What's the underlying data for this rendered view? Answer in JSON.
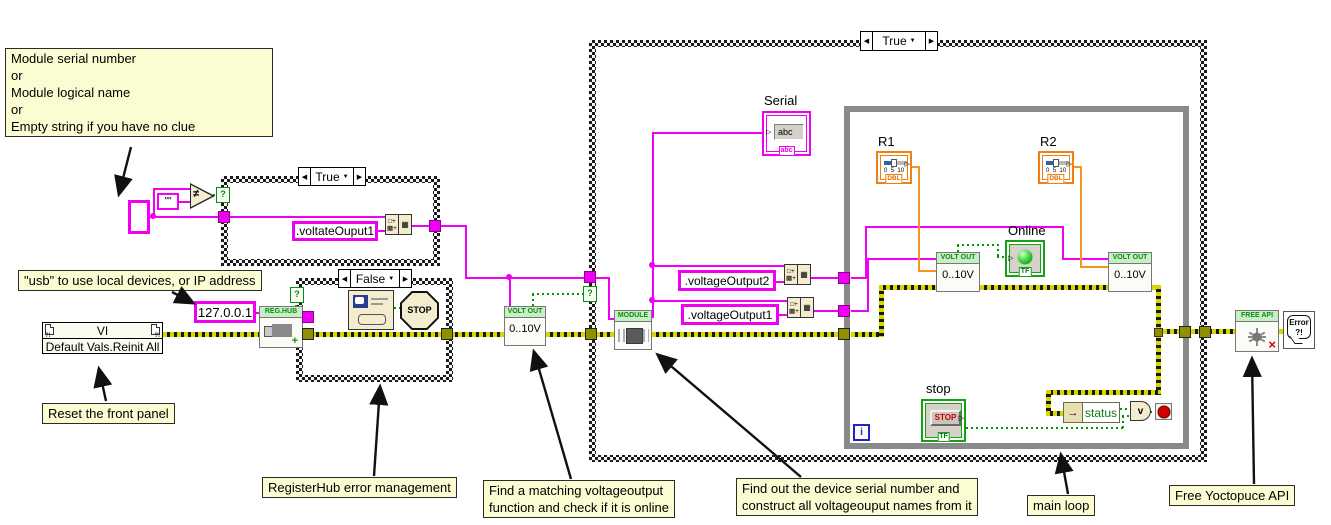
{
  "comments": {
    "module_serial": {
      "l1": "Module serial number",
      "l2": "or",
      "l3": "Module  logical name",
      "l4": "or",
      "l5": "Empty string if you have no clue"
    },
    "usb": "\"usb\" to use local devices, or IP address",
    "reset": "Reset the front panel",
    "reghub": "RegisterHub error management",
    "find_matching": {
      "l1": "Find a matching voltageoutput",
      "l2": "function and check if it is online"
    },
    "find_serial": {
      "l1": "Find out the device serial number  and",
      "l2": "construct all voltageouput names from it"
    },
    "main_loop": "main loop",
    "free_api": "Free Yoctopuce API"
  },
  "structures": {
    "case_name_builder": {
      "selector": "True"
    },
    "case_error": {
      "selector": "False"
    },
    "case_main": {
      "selector": "True"
    }
  },
  "constants": {
    "empty_string": "\"\"",
    "name_suffix_1": ".voltateOuput1",
    "ip": "127.0.0.1",
    "vo2": ".voltageOutput2",
    "vo1": ".voltageOutput1"
  },
  "nodes": {
    "neq": "≠",
    "selector_q": "?",
    "invoke": {
      "title": "VI",
      "method": "Default Vals.Reinit All",
      "flags": "?!"
    },
    "reg_hub": {
      "header": "REG.HUB",
      "plus": "+"
    },
    "stop_sign": "STOP",
    "volt_out": {
      "header": "VOLT OUT",
      "range": "0..10V"
    },
    "module": {
      "header": "MODULE"
    },
    "concat": {
      "g1": "□+",
      "g2": "▩+",
      "g3": "▦"
    },
    "free_api": {
      "header": "FREE API",
      "x": "×"
    },
    "error_handler": {
      "l1": "Error",
      "l2": "?!"
    },
    "unbundle": {
      "arrow": "→",
      "field": "status"
    },
    "or_glyph": "v",
    "iteration": "i"
  },
  "terminals": {
    "serial": {
      "label": "Serial",
      "value": "abc",
      "tag": "abc"
    },
    "r1": {
      "label": "R1"
    },
    "r2": {
      "label": "R2"
    },
    "slider": {
      "tag": "DBL",
      "t0": "0",
      "t5": "5",
      "t10": "10"
    },
    "online": {
      "label": "Online",
      "tag": "TF"
    },
    "stop": {
      "label": "stop",
      "button": "STOP",
      "tag": "TF"
    }
  },
  "ui": {
    "arrow_left": "◀",
    "arrow_right": "▶",
    "dropdown": "▼",
    "nub": "▷"
  },
  "colors": {
    "string_wire": "#F000F0",
    "numeric_wire": "#F7941D",
    "boolean_wire": "#009900",
    "error_wire_yellow": "#D6D600",
    "comment_bg": "#FCFCD2",
    "node_header_bg": "#C6EFC6",
    "loop_border": "#8A8A8A"
  }
}
